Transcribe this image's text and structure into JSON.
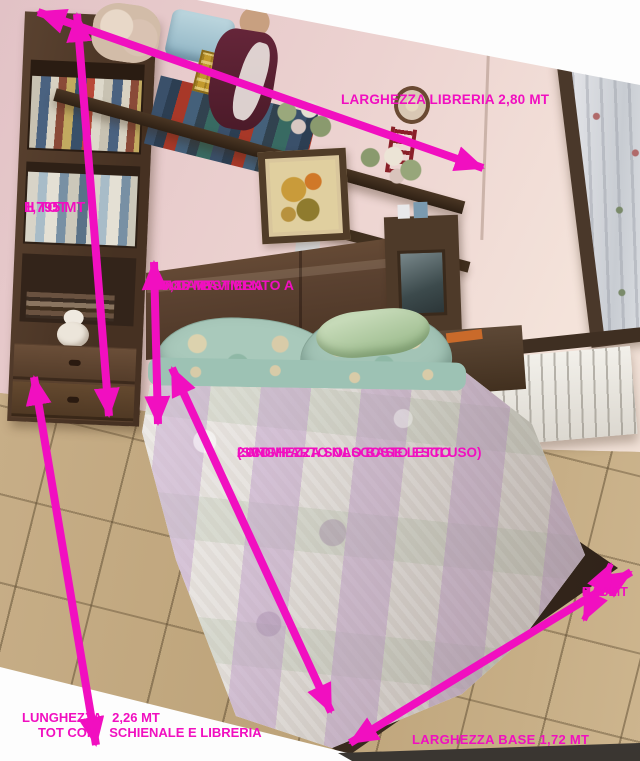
{
  "annotation_color": "#f10fc0",
  "measurements": {
    "libreria_width": {
      "text": "LARGHEZZA LIBRERIA 2,80 MT"
    },
    "total_height": {
      "line1": "H TOT",
      "line2": "1,795 MT"
    },
    "headboard_height": {
      "line1": "H DA PAVIMENTO A",
      "line2": "TOP TESTIERA",
      "line3": "0,85 MT"
    },
    "bed_base_length": {
      "line1": "LUNGHEZZA SOLO BASE LETTO",
      "line2": "(SCOMPARTO NASCOSTO ESCLUSO)",
      "line3": "2 MT"
    },
    "total_length": {
      "part1": "LUNGHEZZA",
      "part2": "2,26 MT",
      "part3": "TOT CON",
      "part4": "SCHIENALE E LIBRERIA"
    },
    "base_height": {
      "line1": "H",
      "line2": "BASE",
      "line3": "0,41 MT"
    },
    "base_width": {
      "text": "LARGHEZZA BASE  1,72 MT"
    }
  }
}
